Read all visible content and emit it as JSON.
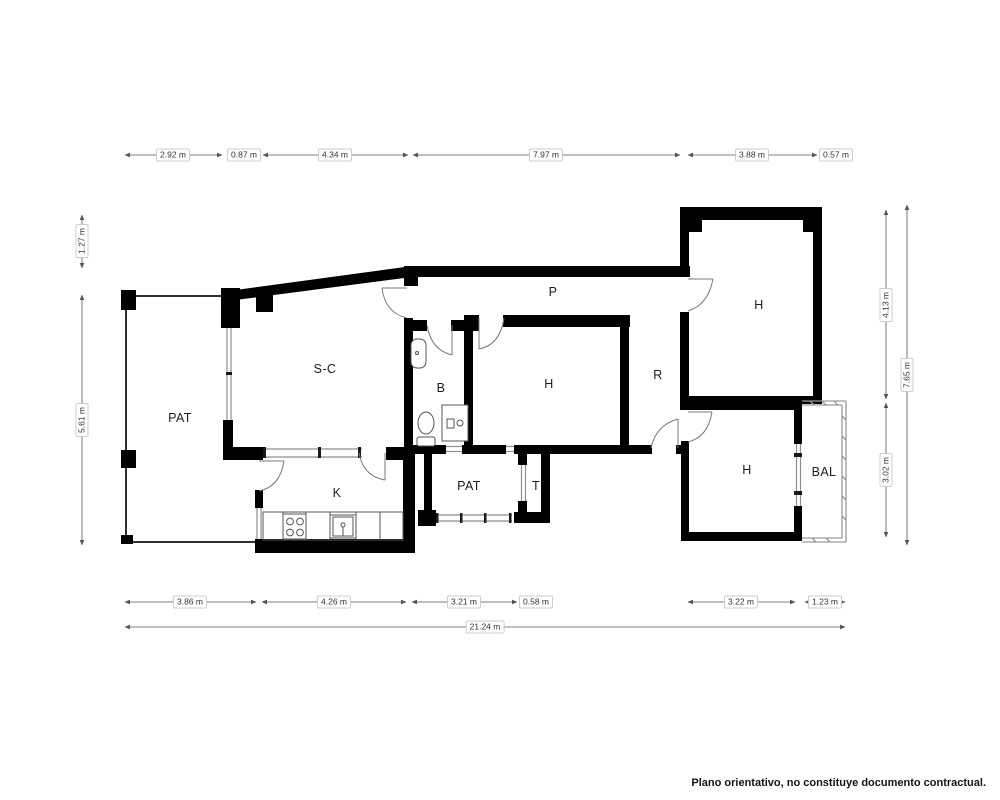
{
  "plan": {
    "rooms": {
      "pat_left": "PAT",
      "sc": "S-C",
      "k": "K",
      "b": "B",
      "h_mid": "H",
      "p": "P",
      "r": "R",
      "h_top": "H",
      "h_bot": "H",
      "bal": "BAL",
      "pat_mid": "PAT",
      "t": "T"
    },
    "icons": {
      "stove": "stove-icon",
      "kitchen_sink": "kitchen-sink-icon",
      "washbasin": "washbasin-icon",
      "toilet": "toilet-icon",
      "washing_machine": "washing-machine-icon",
      "door": "door-arc-icon",
      "window": "window-icon",
      "balcony_railing": "balcony-railing-icon"
    },
    "colors": {
      "wall": "#000000",
      "thin_wall": "#8e8e8e",
      "dimension_line": "#555555",
      "text": "#1c1c1c",
      "background": "#ffffff"
    }
  },
  "dimensions": {
    "top": [
      "2.92 m",
      "0.87 m",
      "4.34 m",
      "7.97 m",
      "3.88 m",
      "0.57 m"
    ],
    "bottom": [
      "3.86 m",
      "4.26 m",
      "3.21 m",
      "0.58 m",
      "3.22 m",
      "1.23 m"
    ],
    "total": "21.24 m",
    "left": [
      "1.27 m",
      "5.61 m"
    ],
    "right": [
      "4.13 m",
      "3.02 m",
      "7.65 m"
    ]
  },
  "footer": {
    "disclaimer": "Plano orientativo, no constituye documento contractual."
  }
}
